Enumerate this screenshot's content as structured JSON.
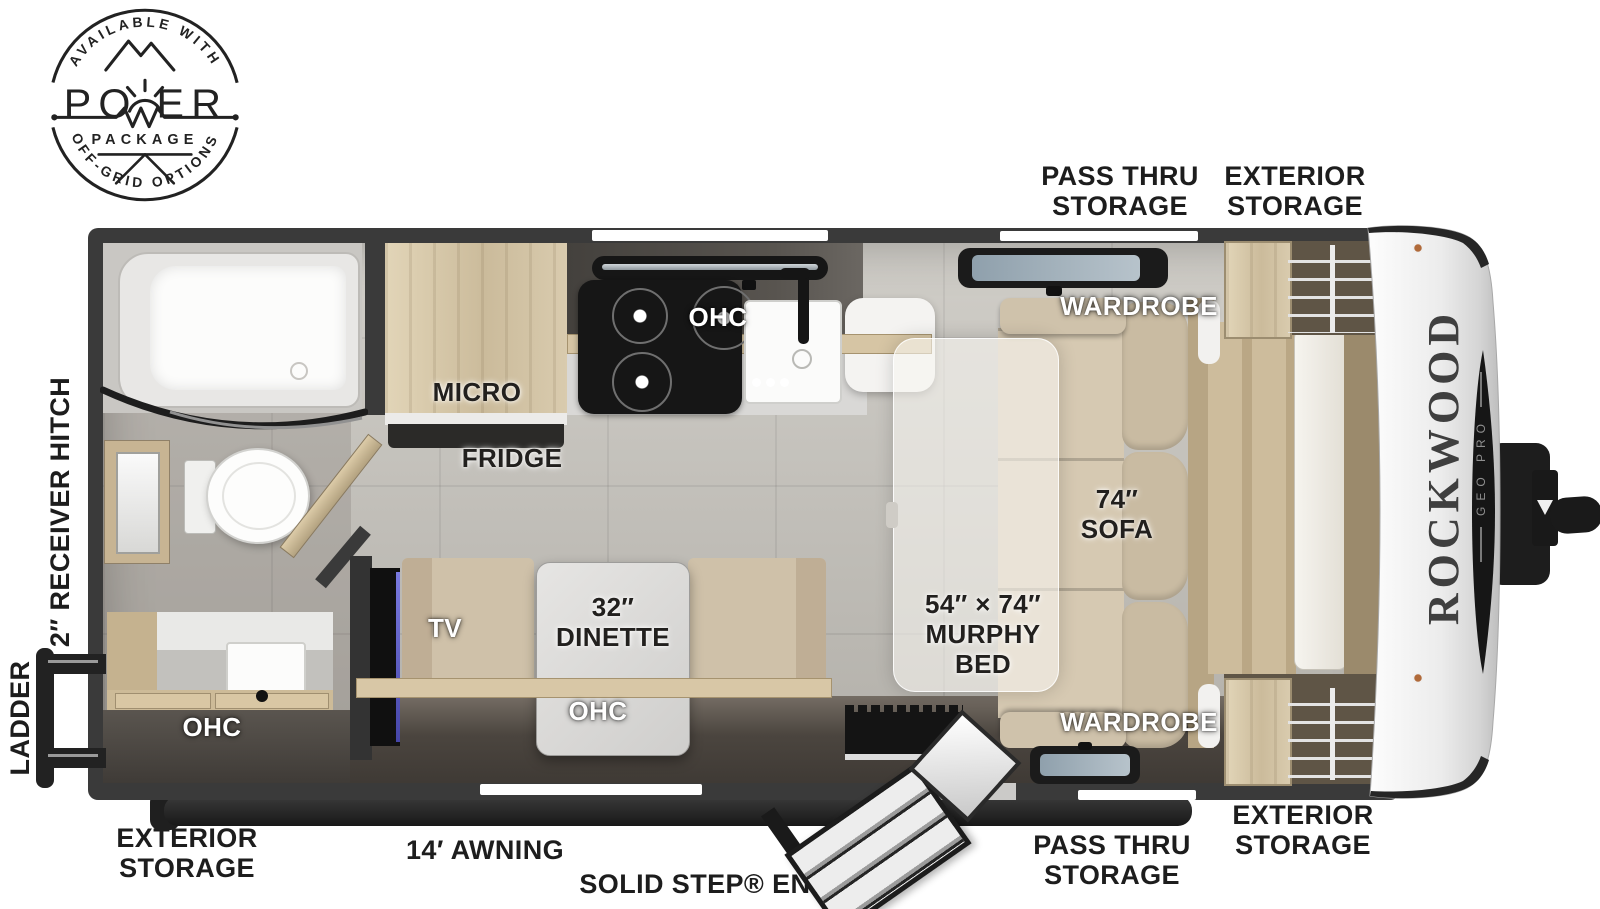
{
  "badge": {
    "arc_top": "AVAILABLE WITH",
    "word_left": "PO",
    "word_right": "ER",
    "line2": "PACKAGE",
    "arc_bottom": "OFF-GRID OPTIONS"
  },
  "brand": {
    "name": "ROCKWOOD",
    "model": "GEO PRO"
  },
  "exterior": {
    "top_pass_thru": [
      "PASS THRU",
      "STORAGE"
    ],
    "top_exterior": [
      "EXTERIOR",
      "STORAGE"
    ],
    "bottom_left_exterior": [
      "EXTERIOR",
      "STORAGE"
    ],
    "awning": "14′ AWNING",
    "entry": "SOLID STEP® ENTRY",
    "bottom_pass_thru": [
      "PASS THRU",
      "STORAGE"
    ],
    "bottom_right_exterior": [
      "EXTERIOR",
      "STORAGE"
    ],
    "receiver_hitch": "2″ RECEIVER HITCH",
    "ladder": "LADDER"
  },
  "interior": {
    "micro": "MICRO",
    "fridge": "FRIDGE",
    "ohc_kitchen": "OHC",
    "ohc_bath": "OHC",
    "ohc_dinette": "OHC",
    "tv": "TV",
    "dinette": [
      "32″",
      "DINETTE"
    ],
    "murphy": [
      "54″ × 74″",
      "MURPHY",
      "BED"
    ],
    "sofa": [
      "74″",
      "SOFA"
    ],
    "wardrobe_top": "WARDROBE",
    "wardrobe_bottom": "WARDROBE"
  },
  "colors": {
    "shell": "#3a3a3a",
    "floor_tile": "#c6c3bc",
    "wood_light": "#d8c9ab",
    "cushion_tan": "#cfc1a9",
    "accent_black": "#1c1c1c",
    "label_black": "#1d1d1d",
    "label_white": "#ffffff"
  }
}
